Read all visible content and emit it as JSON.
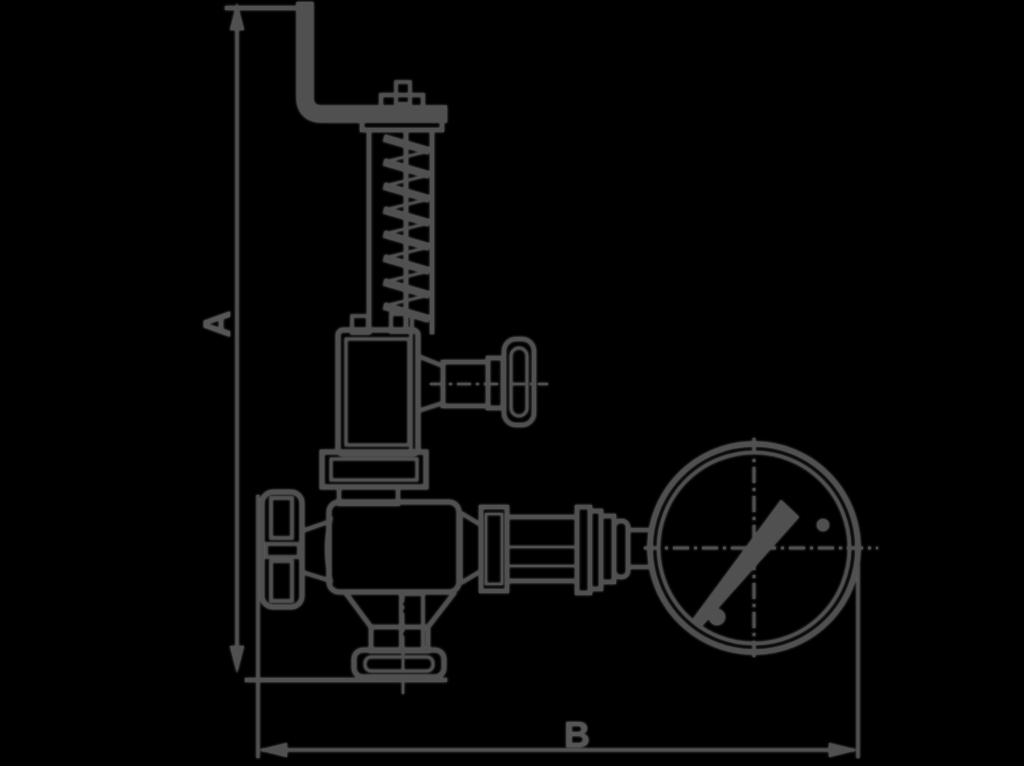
{
  "figure": {
    "background_color": "#000000",
    "ink_color": "#505050",
    "subject": "safety relief valve with test lever, coil spring, side plug, handwheel, bottom outlet and attached pressure gauge"
  },
  "dimension_labels": {
    "vertical": "A",
    "horizontal": "B"
  }
}
